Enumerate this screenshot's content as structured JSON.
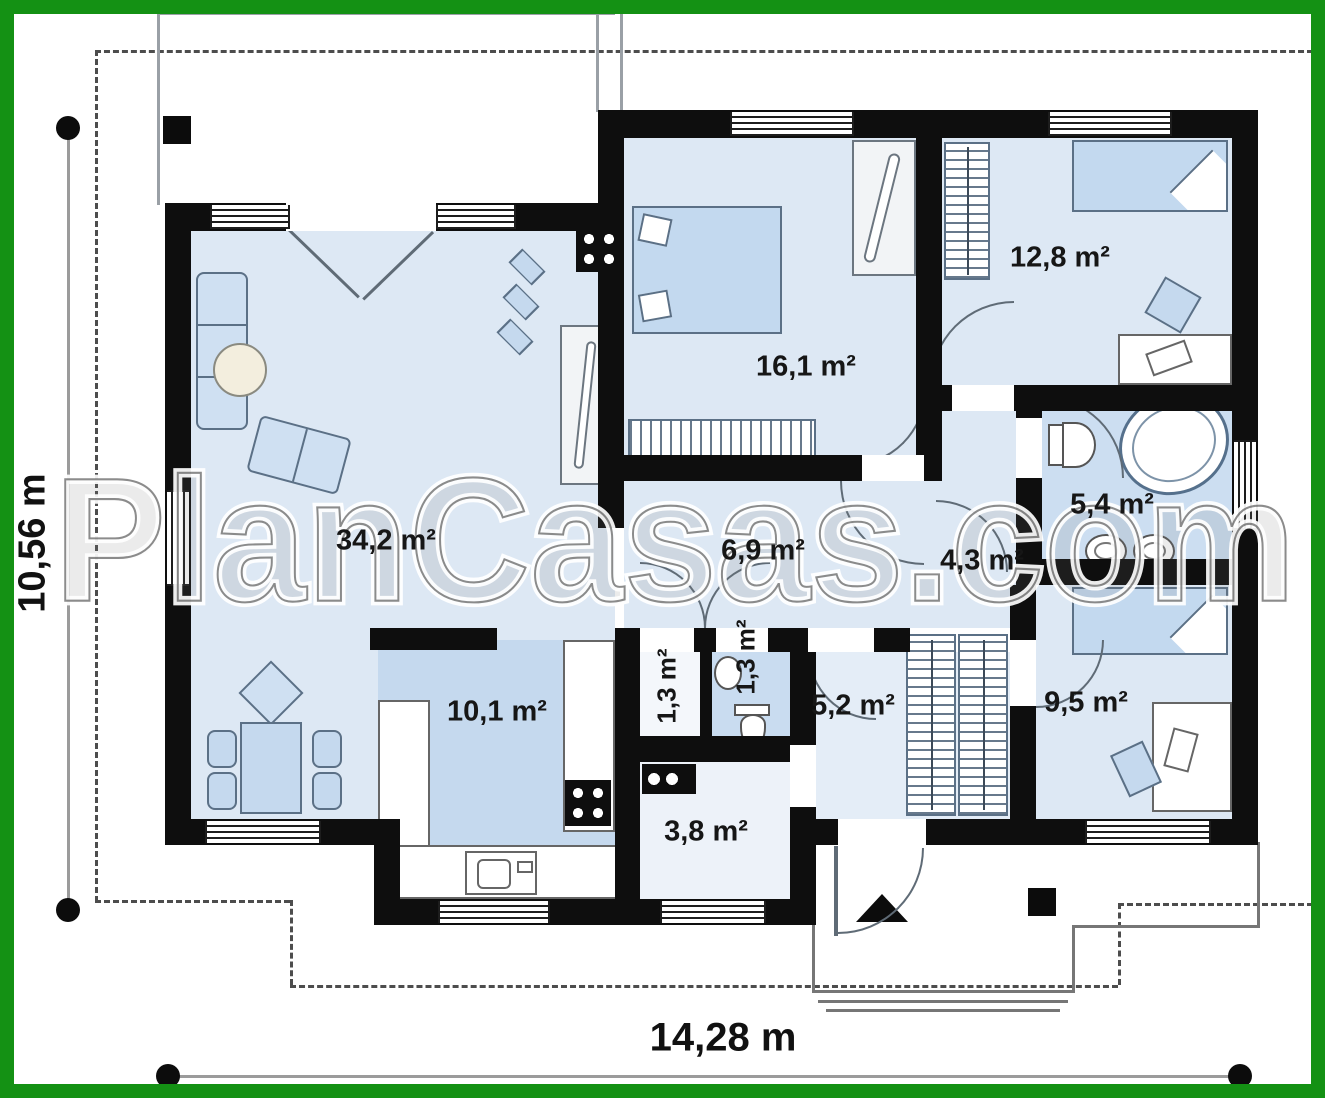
{
  "watermark": "PlanCasas.com",
  "dimensions": {
    "height": "10,56 m",
    "width": "14,28 m"
  },
  "rooms": {
    "living": {
      "area": "34,2 m²"
    },
    "kitchen": {
      "area": "10,1 m²"
    },
    "bedroom_main": {
      "area": "16,1 m²"
    },
    "bedroom_top": {
      "area": "12,8 m²"
    },
    "bathroom": {
      "area": "5,4 m²"
    },
    "corridor": {
      "area": "4,3 m²"
    },
    "hall": {
      "area": "6,9 m²"
    },
    "closet": {
      "area": "1,3 m²"
    },
    "wc": {
      "area": "1,3 m²"
    },
    "hall_entry": {
      "area": "5,2 m²"
    },
    "bedroom_small": {
      "area": "9,5 m²"
    },
    "vestibule": {
      "area": "3,8 m²"
    }
  },
  "colors": {
    "frame_green": "#149114",
    "wall_black": "#0e0e0e",
    "floor_light": "#dde8f4",
    "floor_accent": "#c5d9ee"
  }
}
